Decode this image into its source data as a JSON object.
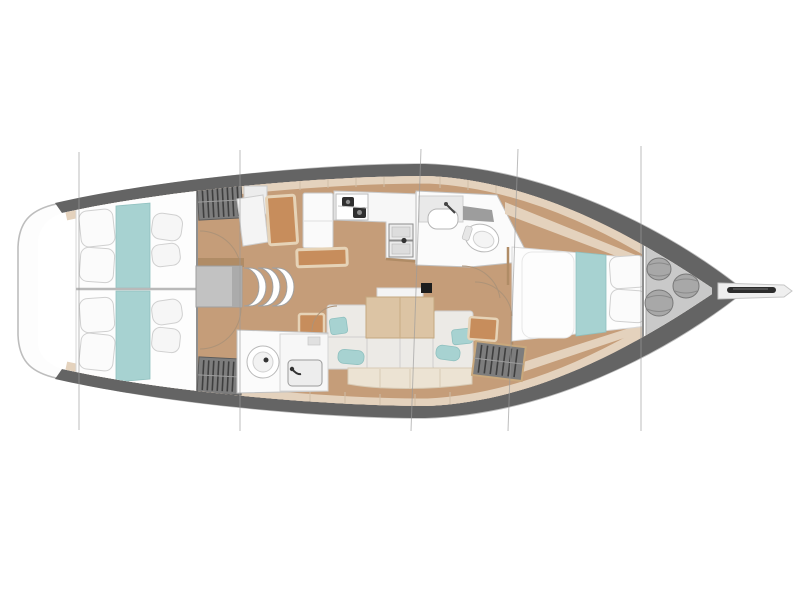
{
  "document": {
    "title": "Sailing yacht interior layout - top view floor plan",
    "type": "yacht deck plan",
    "visible_text": "none"
  },
  "palette": {
    "floor_wood": "#c59d79",
    "trim_beige": "#e4d2bd",
    "trim_seam": "#cfbda6",
    "hull_band": "#646464",
    "hull_outline": "#bdbdbd",
    "deck_white": "#fdfdfd",
    "bed_white": "#fdfdfd",
    "bed_stroke": "#d8d8d8",
    "teal_accent": "#a7d2d1",
    "teal_stroke": "#8fc0bf",
    "cushion_orange": "#c78d5c",
    "wood_frame": "#e6d3b7",
    "wood_wall": "#b08c66",
    "table_wood": "#dcc4a4",
    "table_stroke": "#c5a880",
    "sofa_gray": "#eceae6",
    "backrest_cream": "#ece3d3",
    "locker_gray": "#7d7d7d",
    "locker_slat": "#3f3f3f",
    "fixture_white": "#f7f7f7",
    "metal_dark": "#2f2f2f",
    "step_gray": "#c2c2c2",
    "section_line": "#9b9b9b",
    "fender_gray": "#a8a8a8",
    "door_arc": "#ad9378",
    "locker_panel": "#c9c9c9"
  },
  "plan": {
    "orientation": "bow pointing right, stern at left",
    "sections": [
      "aft double cabin port with teal bed runner",
      "aft double cabin starboard with teal bed runner",
      "hanging lockers with clothes rails",
      "companionway landing and three curved steps",
      "navigation station with seat and desk",
      "aft head with round toilet and sink",
      "L-shaped galley with two-burner stove and twin sinks",
      "forward head with sink, shower and toilet",
      "saloon with C-shaped settee, teal pillows and wood table",
      "mast post",
      "forward owner cabin with island berth and teal runner",
      "forepeak sail locker with three fenders",
      "bowsprit with anchor roller"
    ],
    "section_line_positions_px": [
      79,
      240,
      418,
      515,
      641
    ],
    "berth_count": 3,
    "head_count": 2
  }
}
